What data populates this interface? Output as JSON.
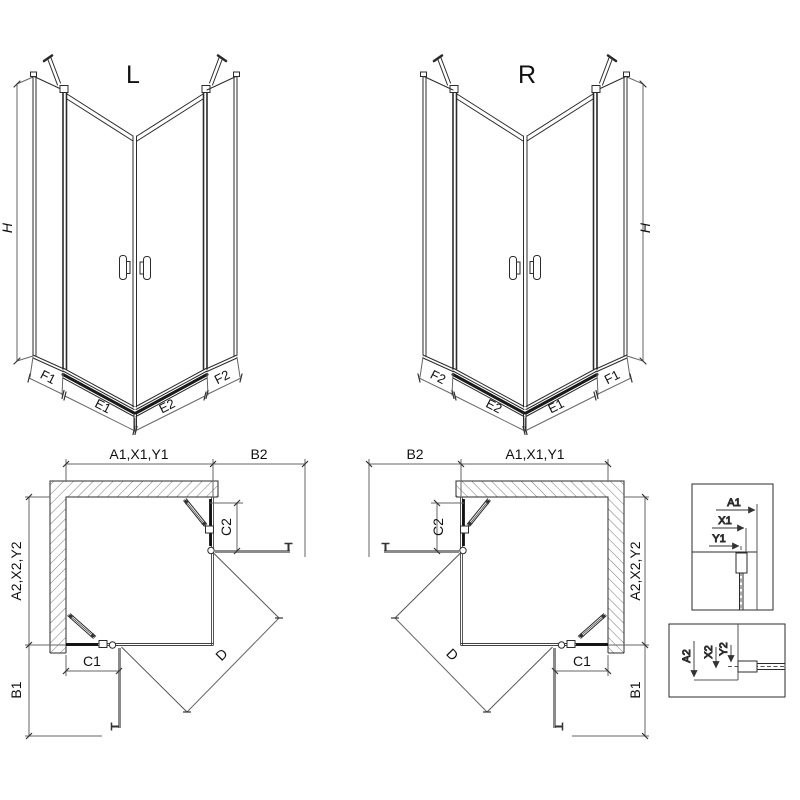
{
  "drawing": {
    "iso_left": {
      "label": "L",
      "height_dim": "H",
      "base_dims": [
        "F1",
        "E1",
        "E2",
        "F2"
      ]
    },
    "iso_right": {
      "label": "R",
      "height_dim": "H",
      "base_dims": [
        "F2",
        "E2",
        "E1",
        "F1"
      ]
    },
    "plan_left": {
      "width_dim": "A1,X1,Y1",
      "side_dim": "B2",
      "depth_dim": "A2,X2,Y2",
      "fixed_side_dim": "C2",
      "fixed_front_dim": "C1",
      "front_dim": "B1",
      "entry_dim": "D"
    },
    "plan_right": {
      "width_dim": "A1,X1,Y1",
      "side_dim": "B2",
      "depth_dim": "A2,X2,Y2",
      "fixed_side_dim": "C2",
      "fixed_front_dim": "C1",
      "front_dim": "B1",
      "entry_dim": "D"
    },
    "detail_width": {
      "dims": [
        "A1",
        "X1",
        "Y1"
      ]
    },
    "detail_depth": {
      "dims": [
        "A2",
        "X2",
        "Y2"
      ]
    }
  }
}
